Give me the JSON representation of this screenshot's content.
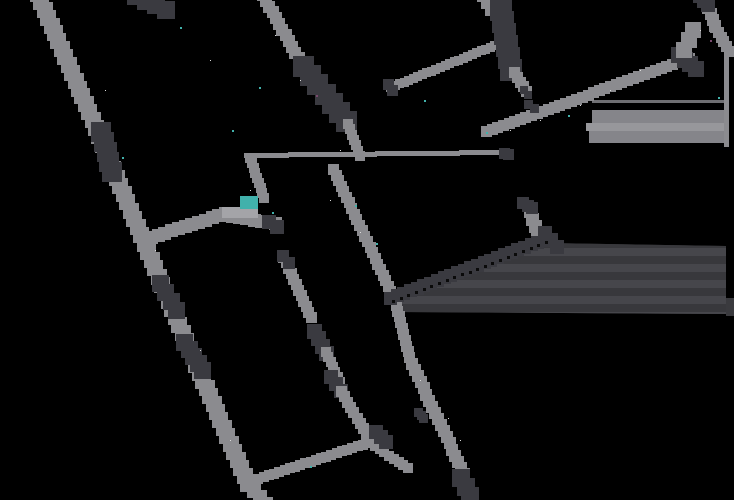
{
  "canvas": {
    "width": 734,
    "height": 500,
    "background": "#000000"
  },
  "floor_plan": {
    "colors": {
      "wall": "#8b8b8f",
      "dark": "#3a3a40",
      "teal": "#41b1ab",
      "patch": "#a4a4a8",
      "stripe_base": "#3a3a3e",
      "stripe_a": "#38383c",
      "stripe_b": "#46464b",
      "slab_a": "#85858a",
      "slab_b": "#97979b",
      "slab_line": "#6f6f73",
      "speckle": "#dcdcdc",
      "purple": "#7a4a6e",
      "dot_line": "#0a0a0a"
    },
    "segments": [
      {
        "name": "outer-wall-top",
        "x1": 38,
        "y1": -6,
        "x2": 96,
        "y2": 128,
        "w": 16,
        "tone": "wall"
      },
      {
        "name": "outer-wall-mid",
        "x1": 96,
        "y1": 128,
        "x2": 162,
        "y2": 285,
        "w": 16,
        "tone": "wall"
      },
      {
        "name": "outer-wall-low",
        "x1": 162,
        "y1": 285,
        "x2": 248,
        "y2": 484,
        "w": 16,
        "tone": "wall"
      },
      {
        "name": "outer-wall-foot",
        "x1": 248,
        "y1": 484,
        "x2": 266,
        "y2": 504,
        "w": 14,
        "tone": "wall"
      },
      {
        "name": "top-dark-fragment",
        "x1": 136,
        "y1": -4,
        "x2": 166,
        "y2": 10,
        "w": 18,
        "tone": "dark"
      },
      {
        "name": "door-outer-1",
        "x1": 101,
        "y1": 132,
        "x2": 112,
        "y2": 172,
        "w": 20,
        "tone": "dark"
      },
      {
        "name": "door-outer-2",
        "x1": 161,
        "y1": 284,
        "x2": 177,
        "y2": 311,
        "w": 17,
        "tone": "dark"
      },
      {
        "name": "door-outer-3",
        "x1": 185,
        "y1": 343,
        "x2": 203,
        "y2": 371,
        "w": 17,
        "tone": "dark"
      },
      {
        "name": "wall2-upper",
        "x1": 263,
        "y1": -5,
        "x2": 305,
        "y2": 70,
        "w": 12,
        "tone": "wall"
      },
      {
        "name": "wall2-dark-bar",
        "x1": 304,
        "y1": 67,
        "x2": 347,
        "y2": 122,
        "w": 21,
        "tone": "dark"
      },
      {
        "name": "wall2-lower",
        "x1": 348,
        "y1": 124,
        "x2": 360,
        "y2": 156,
        "w": 10,
        "tone": "wall"
      },
      {
        "name": "wall3-thin",
        "x1": 247,
        "y1": 156,
        "x2": 502,
        "y2": 153,
        "w": 5,
        "tone": "wall"
      },
      {
        "name": "wall3-cap",
        "x1": 505,
        "y1": 154,
        "x2": 509,
        "y2": 155,
        "w": 11,
        "tone": "dark"
      },
      {
        "name": "junction-vertical",
        "x1": 250,
        "y1": 158,
        "x2": 264,
        "y2": 198,
        "w": 10,
        "tone": "wall"
      },
      {
        "name": "wall4-left",
        "x1": 152,
        "y1": 238,
        "x2": 226,
        "y2": 214,
        "w": 13,
        "tone": "wall"
      },
      {
        "name": "wall4-right",
        "x1": 226,
        "y1": 216,
        "x2": 276,
        "y2": 224,
        "w": 13,
        "tone": "wall"
      },
      {
        "name": "wall4-cap",
        "x1": 269,
        "y1": 222,
        "x2": 277,
        "y2": 227,
        "w": 14,
        "tone": "dark"
      },
      {
        "name": "wall-c",
        "x1": 334,
        "y1": 170,
        "x2": 394,
        "y2": 298,
        "w": 11,
        "tone": "wall"
      },
      {
        "name": "wall-d-1",
        "x1": 284,
        "y1": 258,
        "x2": 312,
        "y2": 318,
        "w": 11,
        "tone": "wall"
      },
      {
        "name": "wall-d-cap",
        "x1": 283,
        "y1": 256,
        "x2": 289,
        "y2": 263,
        "w": 12,
        "tone": "dark"
      },
      {
        "name": "wall-d-dark-1",
        "x1": 315,
        "y1": 332,
        "x2": 327,
        "y2": 354,
        "w": 15,
        "tone": "dark"
      },
      {
        "name": "wall-d-2",
        "x1": 326,
        "y1": 352,
        "x2": 340,
        "y2": 382,
        "w": 10,
        "tone": "wall"
      },
      {
        "name": "wall-d-dark-2",
        "x1": 331,
        "y1": 377,
        "x2": 341,
        "y2": 391,
        "w": 14,
        "tone": "dark"
      },
      {
        "name": "wall-d-3",
        "x1": 342,
        "y1": 392,
        "x2": 370,
        "y2": 440,
        "w": 11,
        "tone": "wall"
      },
      {
        "name": "room-bottom-wall",
        "x1": 248,
        "y1": 482,
        "x2": 368,
        "y2": 443,
        "w": 10,
        "tone": "wall"
      },
      {
        "name": "room-corner-ext",
        "x1": 370,
        "y1": 443,
        "x2": 408,
        "y2": 468,
        "w": 10,
        "tone": "wall"
      },
      {
        "name": "room-corner-dark",
        "x1": 376,
        "y1": 432,
        "x2": 386,
        "y2": 442,
        "w": 14,
        "tone": "dark"
      },
      {
        "name": "wall-e-1",
        "x1": 395,
        "y1": 300,
        "x2": 412,
        "y2": 364,
        "w": 11,
        "tone": "wall"
      },
      {
        "name": "wall-e-2",
        "x1": 412,
        "y1": 364,
        "x2": 464,
        "y2": 474,
        "w": 12,
        "tone": "wall"
      },
      {
        "name": "wall-e-cap",
        "x1": 461,
        "y1": 478,
        "x2": 470,
        "y2": 496,
        "w": 18,
        "tone": "dark"
      },
      {
        "name": "wall-e-arrow",
        "x1": 419,
        "y1": 413,
        "x2": 424,
        "y2": 419,
        "w": 9,
        "tone": "dark"
      },
      {
        "name": "wall-a",
        "x1": 391,
        "y1": 88,
        "x2": 500,
        "y2": 44,
        "w": 9,
        "tone": "wall"
      },
      {
        "name": "wall-a-cap",
        "x1": 389,
        "y1": 85,
        "x2": 393,
        "y2": 91,
        "w": 11,
        "tone": "dark"
      },
      {
        "name": "bar2-top-light",
        "x1": 483,
        "y1": -4,
        "x2": 491,
        "y2": 10,
        "w": 12,
        "tone": "wall"
      },
      {
        "name": "bar2-dark",
        "x1": 501,
        "y1": 10,
        "x2": 511,
        "y2": 70,
        "w": 22,
        "tone": "dark"
      },
      {
        "name": "wall-b",
        "x1": 515,
        "y1": 73,
        "x2": 527,
        "y2": 92,
        "w": 11,
        "tone": "wall"
      },
      {
        "name": "wall-b-dot",
        "x1": 524,
        "y1": 90,
        "x2": 528,
        "y2": 95,
        "w": 8,
        "tone": "dark"
      },
      {
        "name": "wall5-long-diagonal",
        "x1": 487,
        "y1": 132,
        "x2": 690,
        "y2": 59,
        "w": 11,
        "tone": "wall"
      },
      {
        "name": "wall5-dark-seg",
        "x1": 529,
        "y1": 105,
        "x2": 535,
        "y2": 109,
        "w": 9,
        "tone": "dark"
      },
      {
        "name": "junction-dark-right",
        "x1": 679,
        "y1": 55,
        "x2": 696,
        "y2": 69,
        "w": 16,
        "tone": "dark"
      },
      {
        "name": "corner-blob",
        "x1": 684,
        "y1": 50,
        "x2": 693,
        "y2": 30,
        "w": 16,
        "tone": "wall"
      },
      {
        "name": "topright-wall-1",
        "x1": 704,
        "y1": -4,
        "x2": 715,
        "y2": 26,
        "w": 12,
        "tone": "wall"
      },
      {
        "name": "topright-dark-cap",
        "x1": 700,
        "y1": -4,
        "x2": 708,
        "y2": 5,
        "w": 14,
        "tone": "dark"
      },
      {
        "name": "topright-wall-2",
        "x1": 716,
        "y1": 28,
        "x2": 730,
        "y2": 52,
        "w": 11,
        "tone": "wall"
      },
      {
        "name": "right-vertical-line",
        "x1": 727,
        "y1": 52,
        "x2": 727,
        "y2": 145,
        "w": 5,
        "tone": "wall"
      },
      {
        "name": "midright-gray-post",
        "x1": 531,
        "y1": 212,
        "x2": 538,
        "y2": 235,
        "w": 13,
        "tone": "wall"
      },
      {
        "name": "midright-dark-cap",
        "x1": 523,
        "y1": 203,
        "x2": 532,
        "y2": 208,
        "w": 12,
        "tone": "dark"
      },
      {
        "name": "midright-dark-chunk",
        "x1": 545,
        "y1": 233,
        "x2": 557,
        "y2": 247,
        "w": 14,
        "tone": "dark"
      },
      {
        "name": "virtual-wall-bar",
        "x1": 391,
        "y1": 299,
        "x2": 545,
        "y2": 240,
        "w": 13,
        "tone": "dark"
      }
    ],
    "dotted_line": {
      "x1": 392,
      "y1": 300,
      "x2": 545,
      "y2": 241,
      "spacing": 8,
      "size": 3
    },
    "regions": [
      {
        "name": "slab-top-line",
        "type": "rect",
        "x": 592,
        "y": 100,
        "w": 134,
        "h": 3,
        "fill": "slab_line"
      },
      {
        "name": "slab-band-1",
        "type": "rect",
        "x": 592,
        "y": 110,
        "w": 136,
        "h": 13,
        "fill": "slab_a"
      },
      {
        "name": "slab-band-2",
        "type": "rect",
        "x": 586,
        "y": 123,
        "w": 142,
        "h": 8,
        "fill": "slab_b"
      },
      {
        "name": "slab-band-3",
        "type": "rect",
        "x": 589,
        "y": 131,
        "w": 139,
        "h": 12,
        "fill": "slab_a"
      },
      {
        "name": "stripe-corner",
        "type": "rect",
        "x": 726,
        "y": 298,
        "w": 8,
        "h": 18,
        "fill": "stripe_base"
      }
    ],
    "stripe_box": {
      "polygon": [
        [
          390,
          301
        ],
        [
          547,
          243
        ],
        [
          726,
          246
        ],
        [
          726,
          314
        ],
        [
          398,
          312
        ]
      ],
      "band_top": 240,
      "band_bottom": 316,
      "band_height": 8
    },
    "dock_marker": {
      "x": 240,
      "y": 196,
      "w": 18,
      "h": 13
    },
    "light_patch": {
      "x": 222,
      "y": 207,
      "w": 36,
      "h": 11
    },
    "teal_dots": [
      [
        232,
        130
      ],
      [
        122,
        157
      ],
      [
        424,
        100
      ],
      [
        718,
        97
      ],
      [
        486,
        132
      ],
      [
        568,
        115
      ],
      [
        310,
        466
      ],
      [
        355,
        205
      ],
      [
        272,
        212
      ],
      [
        180,
        27
      ],
      [
        376,
        243
      ],
      [
        259,
        87
      ]
    ],
    "purple_dots": [
      [
        710,
        40
      ],
      [
        316,
        95
      ]
    ],
    "speckles": [
      [
        210,
        60
      ],
      [
        250,
        190
      ],
      [
        300,
        80
      ],
      [
        540,
        120
      ],
      [
        640,
        70
      ],
      [
        200,
        350
      ],
      [
        230,
        440
      ],
      [
        330,
        200
      ],
      [
        420,
        380
      ],
      [
        460,
        440
      ],
      [
        580,
        105
      ],
      [
        700,
        30
      ],
      [
        155,
        250
      ],
      [
        105,
        90
      ],
      [
        340,
        150
      ],
      [
        510,
        130
      ],
      [
        610,
        90
      ],
      [
        275,
        35
      ],
      [
        448,
        418
      ],
      [
        360,
        232
      ]
    ]
  }
}
